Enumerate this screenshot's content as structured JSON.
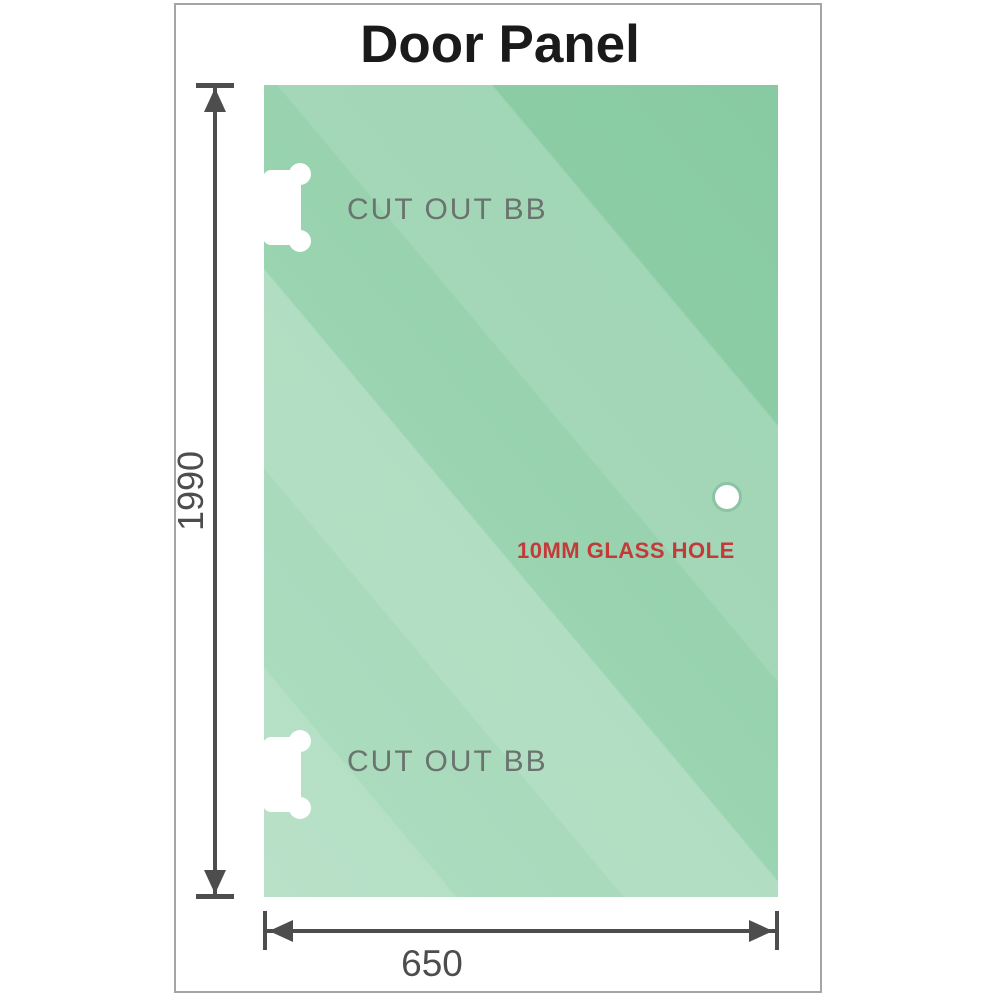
{
  "title": "Door Panel",
  "panel": {
    "cutout_top_label": "CUT OUT BB",
    "cutout_bottom_label": "CUT OUT BB",
    "glass_hole_label": "10MM GLASS HOLE"
  },
  "dimensions": {
    "height": "1990",
    "width": "650"
  },
  "colors": {
    "glass_base": "#83c89e",
    "glass_light": "#b8e2c6",
    "dimension_line": "#4d4d4d",
    "cutout_label_text": "#6b736f",
    "glass_hole_label_text": "#c43a3a",
    "title_text": "#1a1a1a",
    "frame_border": "#a5a5a5"
  }
}
